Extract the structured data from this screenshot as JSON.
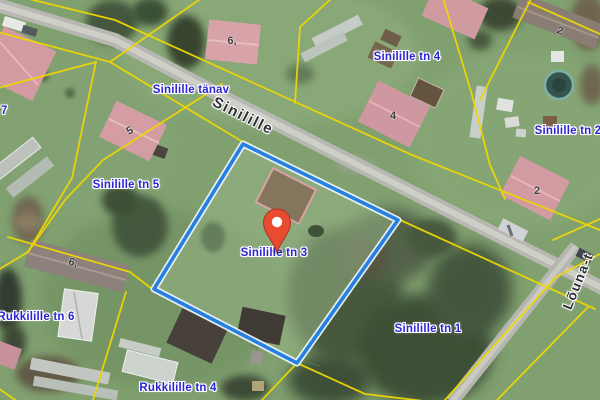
{
  "colors": {
    "label_blue": "#2b24d2",
    "road_label": "#2e2e33",
    "cadastral_yellow": "#ecd604",
    "parcel_blue": "#2580e4",
    "marker_red": "#e84b30"
  },
  "map": {
    "street_labels": [
      {
        "id": "street-name-plate",
        "text": "Sinilille tänav"
      },
      {
        "id": "road-inline-name",
        "text": "Sinilille"
      },
      {
        "id": "road-inline-name-right",
        "text": "Lõuna-t"
      }
    ],
    "address_labels": [
      {
        "id": "sinilille-tn-4",
        "text": "Sinilille tn 4"
      },
      {
        "id": "sinilille-tn-2",
        "text": "Sinilille tn 2"
      },
      {
        "id": "sinilille-tn-5",
        "text": "Sinilille tn 5"
      },
      {
        "id": "sinilille-tn-3",
        "text": "Sinilille tn 3"
      },
      {
        "id": "sinilille-tn-1",
        "text": "Sinilille tn 1"
      },
      {
        "id": "rukkilille-tn-6",
        "text": "Rukkilille tn 6"
      },
      {
        "id": "rukkilille-tn-4",
        "text": "Rukkilille tn 4"
      },
      {
        "id": "edge-parcel-7",
        "text": "7"
      }
    ],
    "building_numbers": [
      {
        "id": "bn-6-top",
        "text": "6,"
      },
      {
        "id": "bn-2-topright",
        "text": "2"
      },
      {
        "id": "bn-4",
        "text": "4"
      },
      {
        "id": "bn-2-right",
        "text": "2"
      },
      {
        "id": "bn-5",
        "text": "5"
      },
      {
        "id": "bn-6-bottomleft",
        "text": "6,"
      }
    ]
  }
}
